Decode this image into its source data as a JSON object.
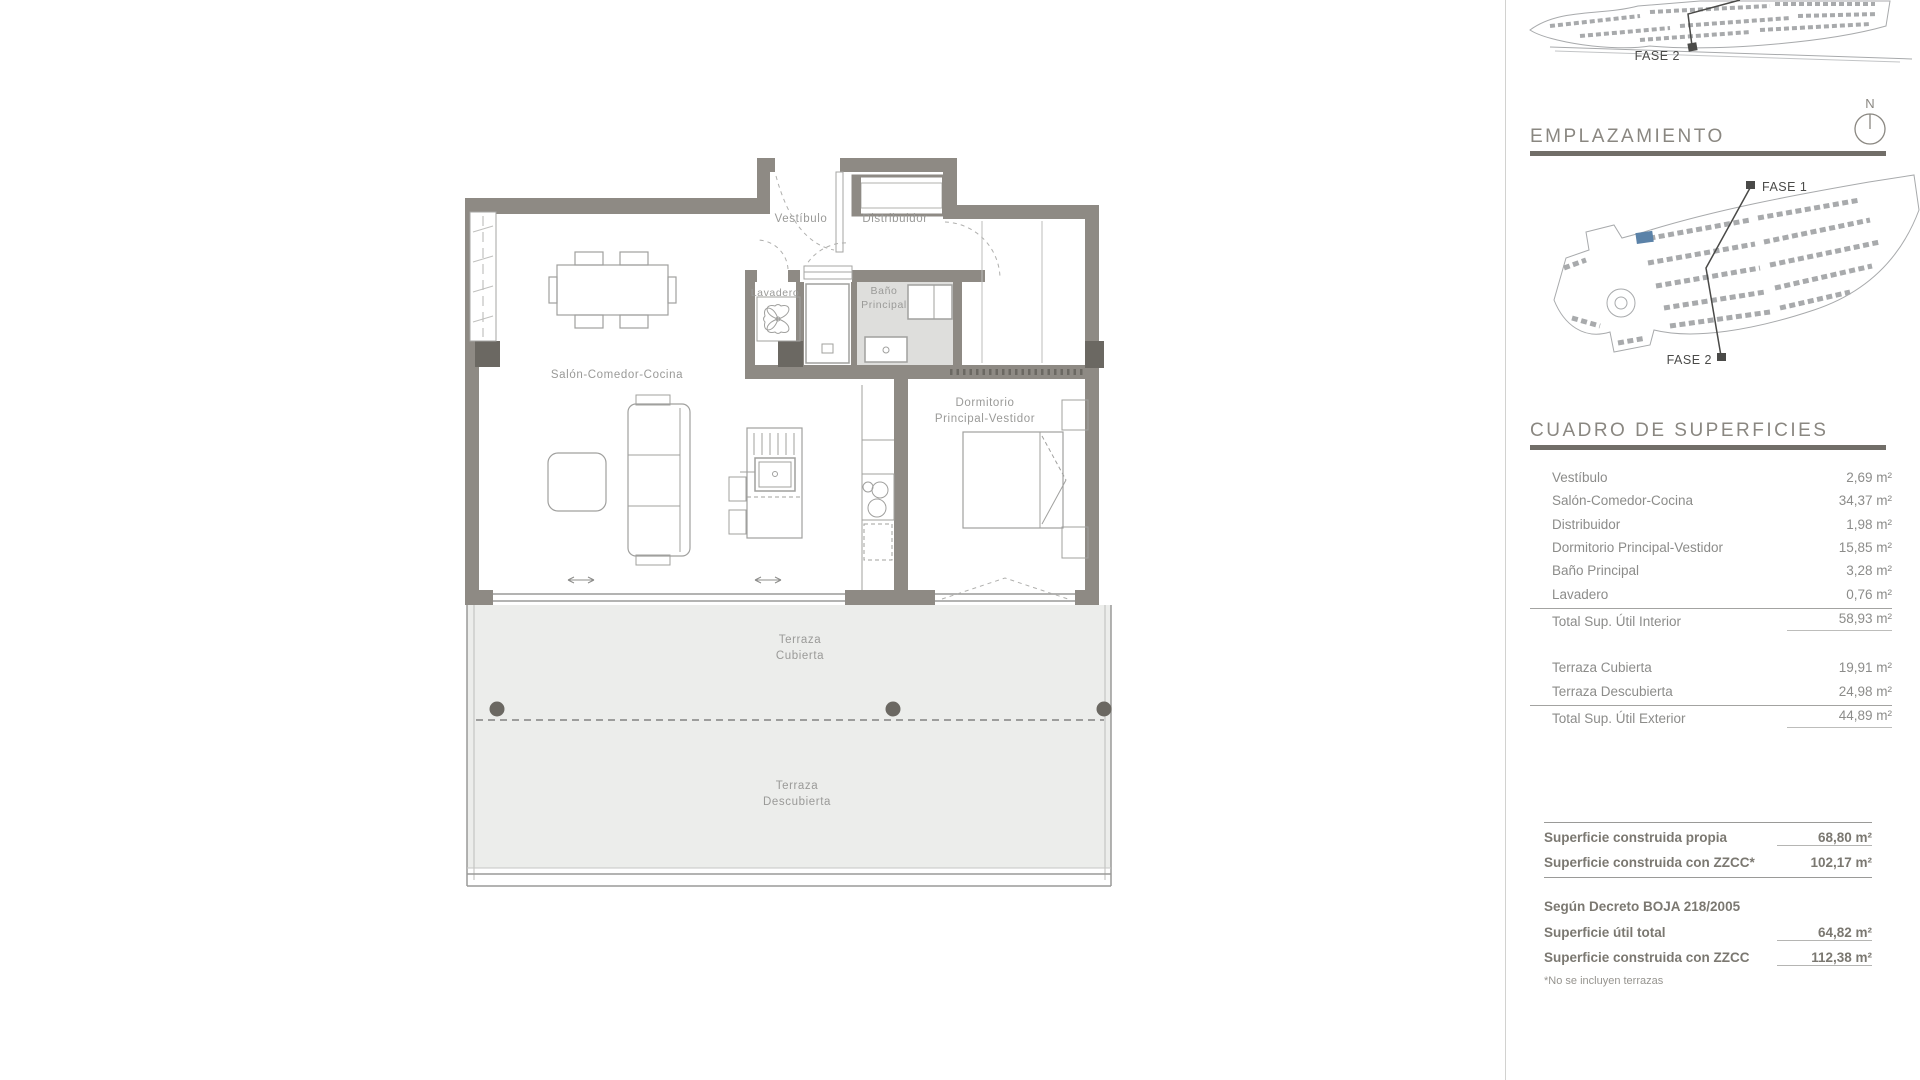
{
  "sidebar": {
    "emplazamiento_title": "EMPLAZAMIENTO",
    "cuadro_title": "CUADRO DE SUPERFICIES",
    "north_label": "N",
    "top_map": {
      "fase2_label": "FASE 2"
    },
    "site_map": {
      "fase1_label": "FASE 1",
      "fase2_label": "FASE 2"
    },
    "accent_blue": "#5b82a8"
  },
  "surfaces": {
    "rows": [
      {
        "label": "Vestíbulo",
        "value": "2,69 m²"
      },
      {
        "label": "Salón-Comedor-Cocina",
        "value": "34,37 m²"
      },
      {
        "label": "Distribuidor",
        "value": "1,98 m²"
      },
      {
        "label": "Dormitorio Principal-Vestidor",
        "value": "15,85 m²"
      },
      {
        "label": "Baño Principal",
        "value": "3,28 m²"
      },
      {
        "label": "Lavadero",
        "value": "0,76 m²"
      }
    ],
    "total_interior": {
      "label": "Total Sup. Útil Interior",
      "value": "58,93 m²"
    },
    "exterior_rows": [
      {
        "label": "Terraza Cubierta",
        "value": "19,91 m²"
      },
      {
        "label": "Terraza Descubierta",
        "value": "24,98 m²"
      }
    ],
    "total_exterior": {
      "label": "Total Sup. Útil Exterior",
      "value": "44,89 m²"
    }
  },
  "construida": {
    "propia": {
      "label": "Superficie construida propia",
      "value": "68,80 m²"
    },
    "con_zzcc": {
      "label": "Superficie construida con ZZCC*",
      "value": "102,17 m²"
    },
    "decreto_heading": "Según Decreto BOJA 218/2005",
    "util_total": {
      "label": "Superficie útil total",
      "value": "64,82 m²"
    },
    "construida_zzcc": {
      "label": "Superficie construida con ZZCC",
      "value": "112,38 m²"
    },
    "footnote": "*No se incluyen terrazas"
  },
  "plan": {
    "labels": {
      "vestibulo": "Vestíbulo",
      "distribuidor": "Distribuidor",
      "lavadero": "Lavadero",
      "bano_1": "Baño",
      "bano_2": "Principal",
      "salon": "Salón-Comedor-Cocina",
      "dormitorio_1": "Dormitorio",
      "dormitorio_2": "Principal-Vestidor",
      "terraza_cubierta_1": "Terraza",
      "terraza_cubierta_2": "Cubierta",
      "terraza_descubierta_1": "Terraza",
      "terraza_descubierta_2": "Descubierta"
    },
    "colors": {
      "wall": "#8e8a84",
      "pillar": "#6b6862",
      "terrace_fill": "#ecedeb",
      "bath_fill": "#dededc",
      "line": "#a5a5a3",
      "label_text": "#9a9a98"
    }
  }
}
